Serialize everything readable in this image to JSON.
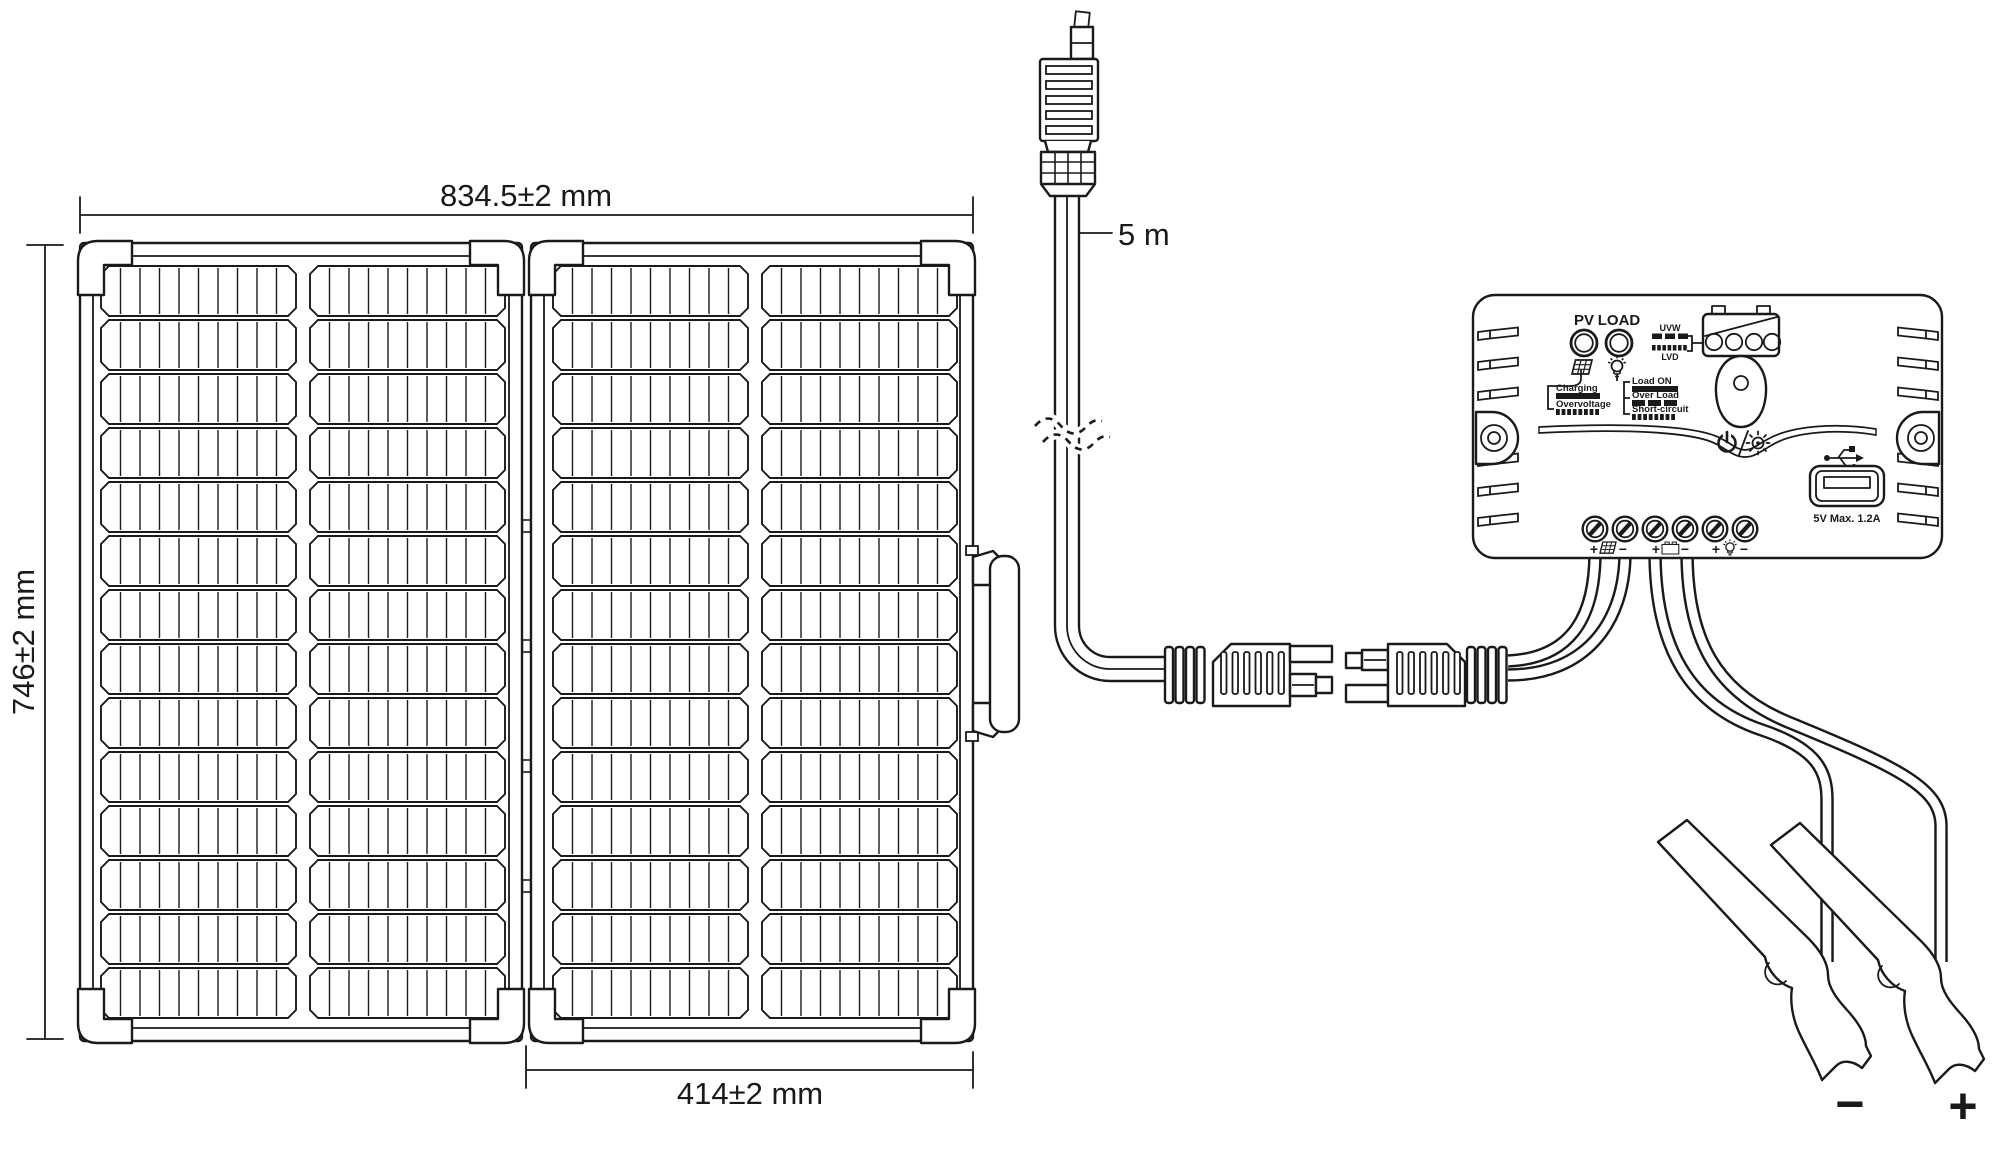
{
  "colors": {
    "ink": "#1a1a1a",
    "background": "#ffffff"
  },
  "panel": {
    "width_dim": "834.5±2 mm",
    "height_dim": "746±2 mm",
    "half_width_dim": "414±2 mm"
  },
  "cable": {
    "length_label": "5 m"
  },
  "controller": {
    "pv_label": "PV",
    "load_label": "LOAD",
    "uvw_label": "UVW",
    "lvd_label": "LVD",
    "charging_label": "Charging",
    "overvoltage_label": "Overvoltage",
    "load_on_label": "Load ON",
    "over_load_label": "Over Load",
    "short_circuit_label": "Short-circuit",
    "usb_rating": "5V  Max. 1.2A",
    "terminals": {
      "pv_plus": "+",
      "pv_minus": "−",
      "battery_plus": "+",
      "battery_minus": "−",
      "load_plus": "+",
      "load_minus": "−"
    }
  },
  "clamps": {
    "negative_label": "−",
    "positive_label": "+"
  }
}
